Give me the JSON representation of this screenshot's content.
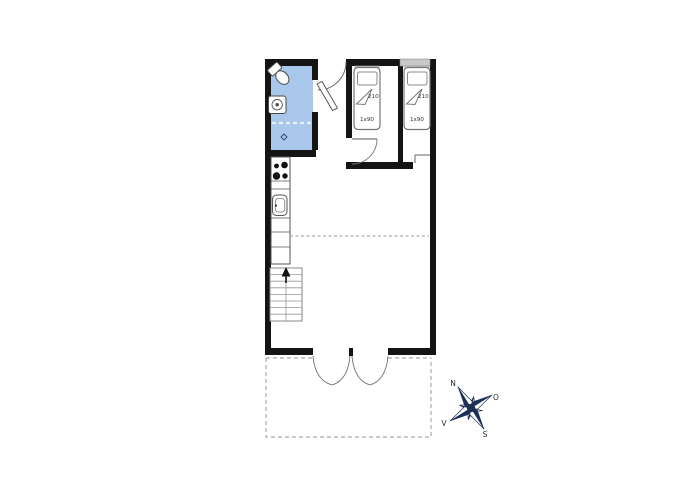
{
  "floorplan": {
    "type": "architectural-floor-plan",
    "colors": {
      "wall": "#141414",
      "bathroom": "#a9c7ea",
      "window": "#c9c9c9",
      "compass": "#1e2f55",
      "dashed_outline": "#ababab",
      "thin_line": "#555555"
    },
    "beds": [
      {
        "length_label": "210",
        "width_label": "1x90"
      },
      {
        "length_label": "210",
        "width_label": "1x90"
      }
    ],
    "compass": {
      "north": "N",
      "east": "O",
      "south": "S",
      "west": "V"
    }
  }
}
